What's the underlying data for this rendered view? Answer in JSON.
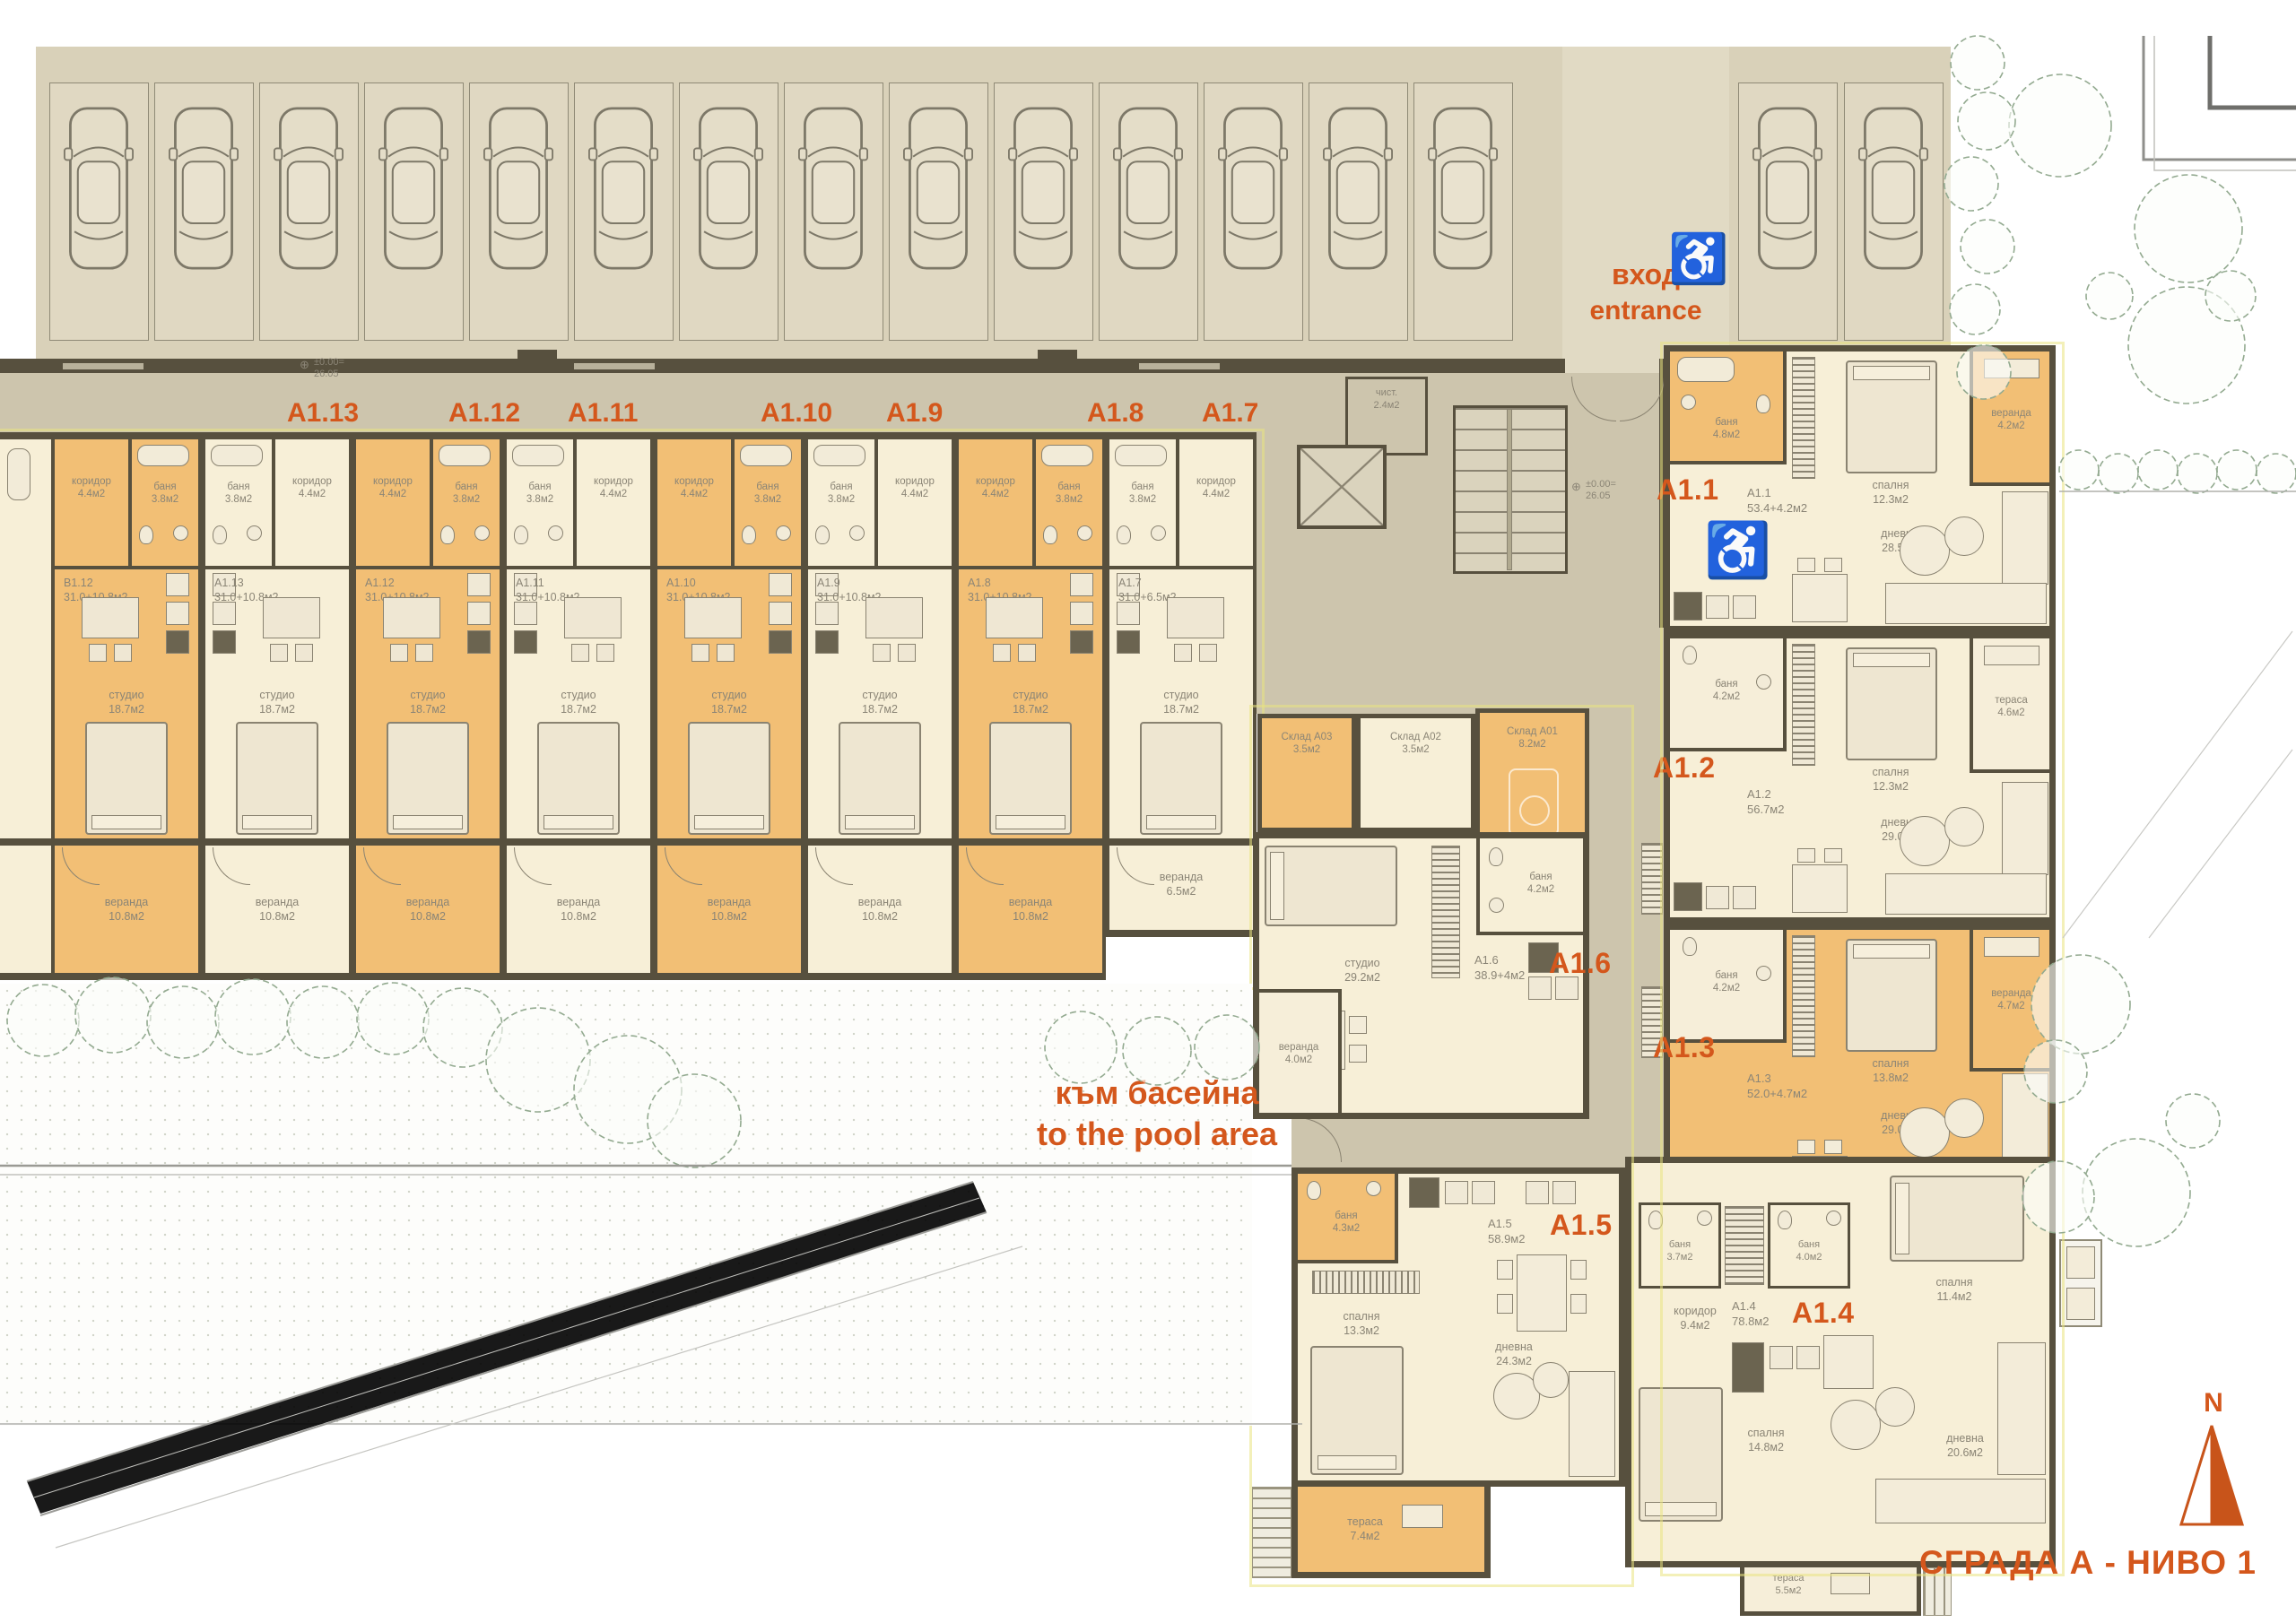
{
  "title": "СГРАДА А - НИВО 1",
  "north": "N",
  "entrance": {
    "line1": "вход",
    "line2": "entrance"
  },
  "pool": {
    "line1": "към басейна",
    "line2": "to the pool area"
  },
  "elevation": "±0.00=\n26.05",
  "core": {
    "clean_room": "чист.\n2.4м2"
  },
  "parking": {
    "left_count": 14,
    "right_count": 2
  },
  "studios": {
    "top_labels": [
      "A1.13",
      "A1.12",
      "A1.11",
      "A1.10",
      "A1.9",
      "A1.8",
      "A1.7"
    ],
    "shared_rooms": {
      "bath": "баня\n3.8м2",
      "hall": "коридор\n4.4м2",
      "studio": "студио\n18.7м2"
    },
    "units": [
      {
        "info": "B1.12\n31.0+10.8м2",
        "veranda": "веранда\n10.8м2",
        "color": "orange"
      },
      {
        "info": "A1.13\n31.0+10.8м2",
        "veranda": "веранда\n10.8м2",
        "color": "cream"
      },
      {
        "info": "A1.12\n31.0+10.8м2",
        "veranda": "веранда\n10.8м2",
        "color": "orange"
      },
      {
        "info": "A1.11\n31.0+10.8м2",
        "veranda": "веранда\n10.8м2",
        "color": "cream"
      },
      {
        "info": "A1.10\n31.0+10.8м2",
        "veranda": "веранда\n10.8м2",
        "color": "orange"
      },
      {
        "info": "A1.9\n31.0+10.8м2",
        "veranda": "веранда\n10.8м2",
        "color": "cream"
      },
      {
        "info": "A1.8\n31.0+10.8м2",
        "veranda": "веранда\n10.8м2",
        "color": "orange"
      },
      {
        "info": "A1.7\n31.0+6.5м2",
        "veranda": "веранда\n6.5м2",
        "color": "cream"
      }
    ]
  },
  "storage": {
    "a03": "Склад A03\n3.5м2",
    "a02": "Склад A02\n3.5м2",
    "a01": "Склад A01\n8.2м2"
  },
  "apartments": {
    "a11": {
      "label": "A1.1",
      "info": "A1.1\n53.4+4.2м2",
      "bath": "баня\n4.8м2",
      "bedroom": "спалня\n12.3м2",
      "veranda": "веранда\n4.2м2",
      "living": "дневна\n28.5м2"
    },
    "a12": {
      "label": "A1.2",
      "info": "A1.2\n56.7м2",
      "bath": "баня\n4.2м2",
      "bedroom": "спалня\n12.3м2",
      "terrace": "тераса\n4.6м2",
      "living": "дневна\n29.0м2"
    },
    "a13": {
      "label": "A1.3",
      "info": "A1.3\n52.0+4.7м2",
      "bath": "баня\n4.2м2",
      "bedroom": "спалня\n13.8м2",
      "veranda": "веранда\n4.7м2",
      "living": "дневна\n29.0м2"
    },
    "a14": {
      "label": "A1.4",
      "info": "A1.4\n78.8м2",
      "hall": "коридор\n9.4м2",
      "bath1": "баня\n3.7м2",
      "bath2": "баня\n4.0м2",
      "bedroom1": "спалня\n11.4м2",
      "bedroom2": "спалня\n14.8м2",
      "living": "дневна\n20.6м2",
      "terrace": "тераса\n5.5м2"
    },
    "a15": {
      "label": "A1.5",
      "info": "A1.5\n58.9м2",
      "bath": "баня\n4.3м2",
      "bedroom": "спалня\n13.3м2",
      "living": "дневна\n24.3м2",
      "terrace": "тераса\n7.4м2"
    },
    "a16": {
      "label": "A1.6",
      "info": "A1.6\n38.9+4м2",
      "studio": "студио\n29.2м2",
      "bath": "баня\n4.2м2",
      "veranda": "веранда\n4.0м2"
    }
  }
}
